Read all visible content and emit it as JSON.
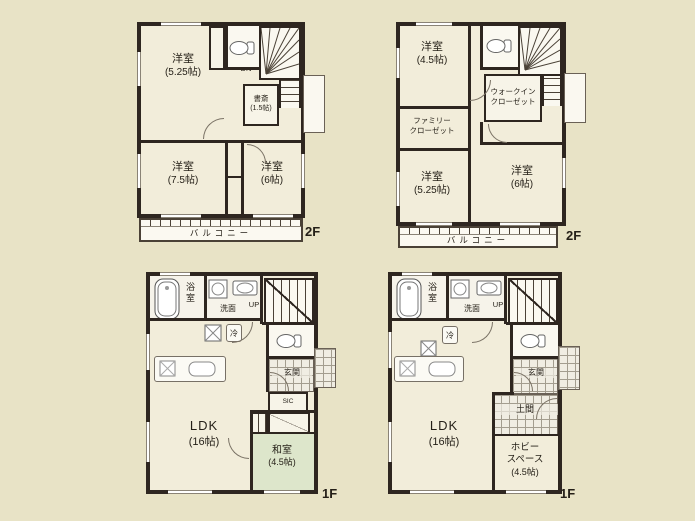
{
  "colors": {
    "background": "#e8e3c6",
    "wall": "#2e2620",
    "room_floor": "#f2edda",
    "tatami_green": "#dde6cb",
    "tile_gray": "#a39d8f"
  },
  "plans": {
    "tl": {
      "floor": "2F",
      "dn": "DN",
      "balcony": "バルコニー",
      "room_a_name": "洋室",
      "room_a_size": "(5.25帖)",
      "room_b_name": "洋室",
      "room_b_size": "(7.5帖)",
      "room_c_name": "洋室",
      "room_c_size": "(6帖)",
      "study_name": "書斎",
      "study_size": "(1.5帖)"
    },
    "tr": {
      "floor": "2F",
      "dn": "DN",
      "balcony": "バルコニー",
      "room_a_name": "洋室",
      "room_a_size": "(4.5帖)",
      "wic_line1": "ウォークイン",
      "wic_line2": "クローゼット",
      "fam_line1": "ファミリー",
      "fam_line2": "クローゼット",
      "room_b_name": "洋室",
      "room_b_size": "(5.25帖)",
      "room_c_name": "洋室",
      "room_c_size": "(6帖)"
    },
    "bl": {
      "floor": "1F",
      "up": "UP",
      "bath": "浴室",
      "wash": "洗面",
      "fridge": "冷",
      "genkan": "玄関",
      "sic": "SIC",
      "ldk_name": "LDK",
      "ldk_size": "(16帖)",
      "washitsu_name": "和室",
      "washitsu_size": "(4.5帖)"
    },
    "br": {
      "floor": "1F",
      "up": "UP",
      "bath": "浴室",
      "wash": "洗面",
      "fridge": "冷",
      "genkan": "玄関",
      "doma": "土間",
      "ldk_name": "LDK",
      "ldk_size": "(16帖)",
      "hobby_line1": "ホビー",
      "hobby_line2": "スペース",
      "hobby_size": "(4.5帖)"
    }
  }
}
